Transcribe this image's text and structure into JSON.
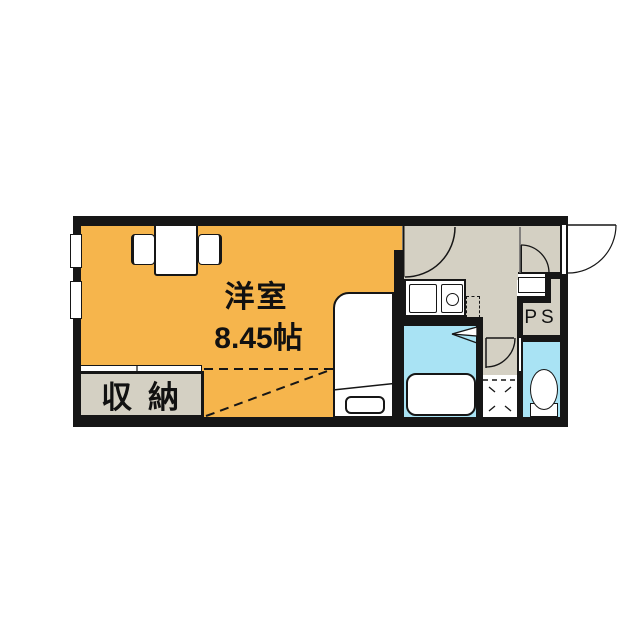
{
  "rooms": {
    "main": {
      "label": "洋室",
      "size": "8.45帖"
    },
    "closet": {
      "label": "収納"
    },
    "ps": {
      "label": "PS"
    }
  },
  "fixtures": [
    "dining-table",
    "chair",
    "chair",
    "bed",
    "bed-foot-shelf",
    "kitchen-sink",
    "stove-burner",
    "refrigerator-space",
    "bathtub",
    "toilet",
    "washing-machine-space",
    "shoe-cabinet",
    "window",
    "entrance-door",
    "kitchen-door",
    "entry-inner-door",
    "toilet-door",
    "bathroom-folding-door",
    "closet-sliding-door"
  ],
  "colors": {
    "room_orange": "#F6B54C",
    "floor_gray": "#D4D0C3",
    "water_cyan": "#A9E3F4",
    "wall_black": "#161616",
    "background": "#FFFFFF"
  }
}
